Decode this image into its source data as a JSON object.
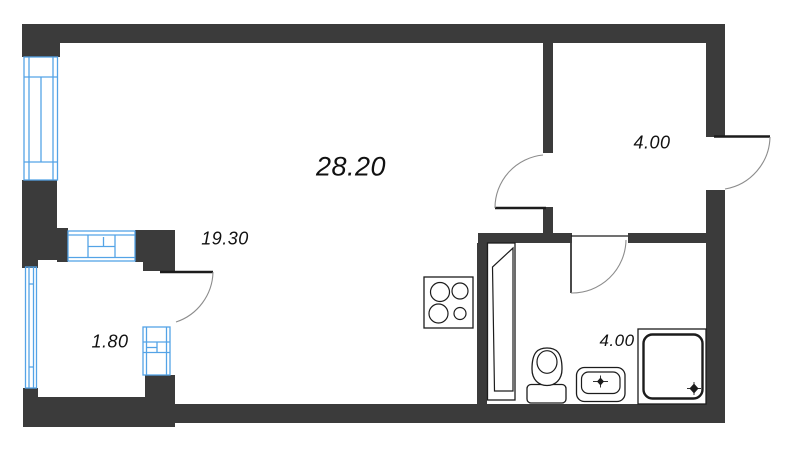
{
  "floor_plan": {
    "rooms": [
      {
        "name": "living-room",
        "area_label": "28.20"
      },
      {
        "name": "kitchen-living-zone",
        "area_label": "19.30"
      },
      {
        "name": "hallway",
        "area_label": "4.00"
      },
      {
        "name": "bathroom",
        "area_label": "4.00"
      },
      {
        "name": "balcony",
        "area_label": "1.80"
      }
    ],
    "fixtures": [
      "cooktop-icon",
      "ventilation-shaft-icon",
      "toilet-icon",
      "sink-icon",
      "shower-tray-icon"
    ],
    "colors": {
      "wall": "#3b3b3b",
      "window_frame": "#54a3e6",
      "fixture_outline": "#1c1c1c",
      "door_arc": "#8c8c8c",
      "background": "#ffffff"
    }
  }
}
